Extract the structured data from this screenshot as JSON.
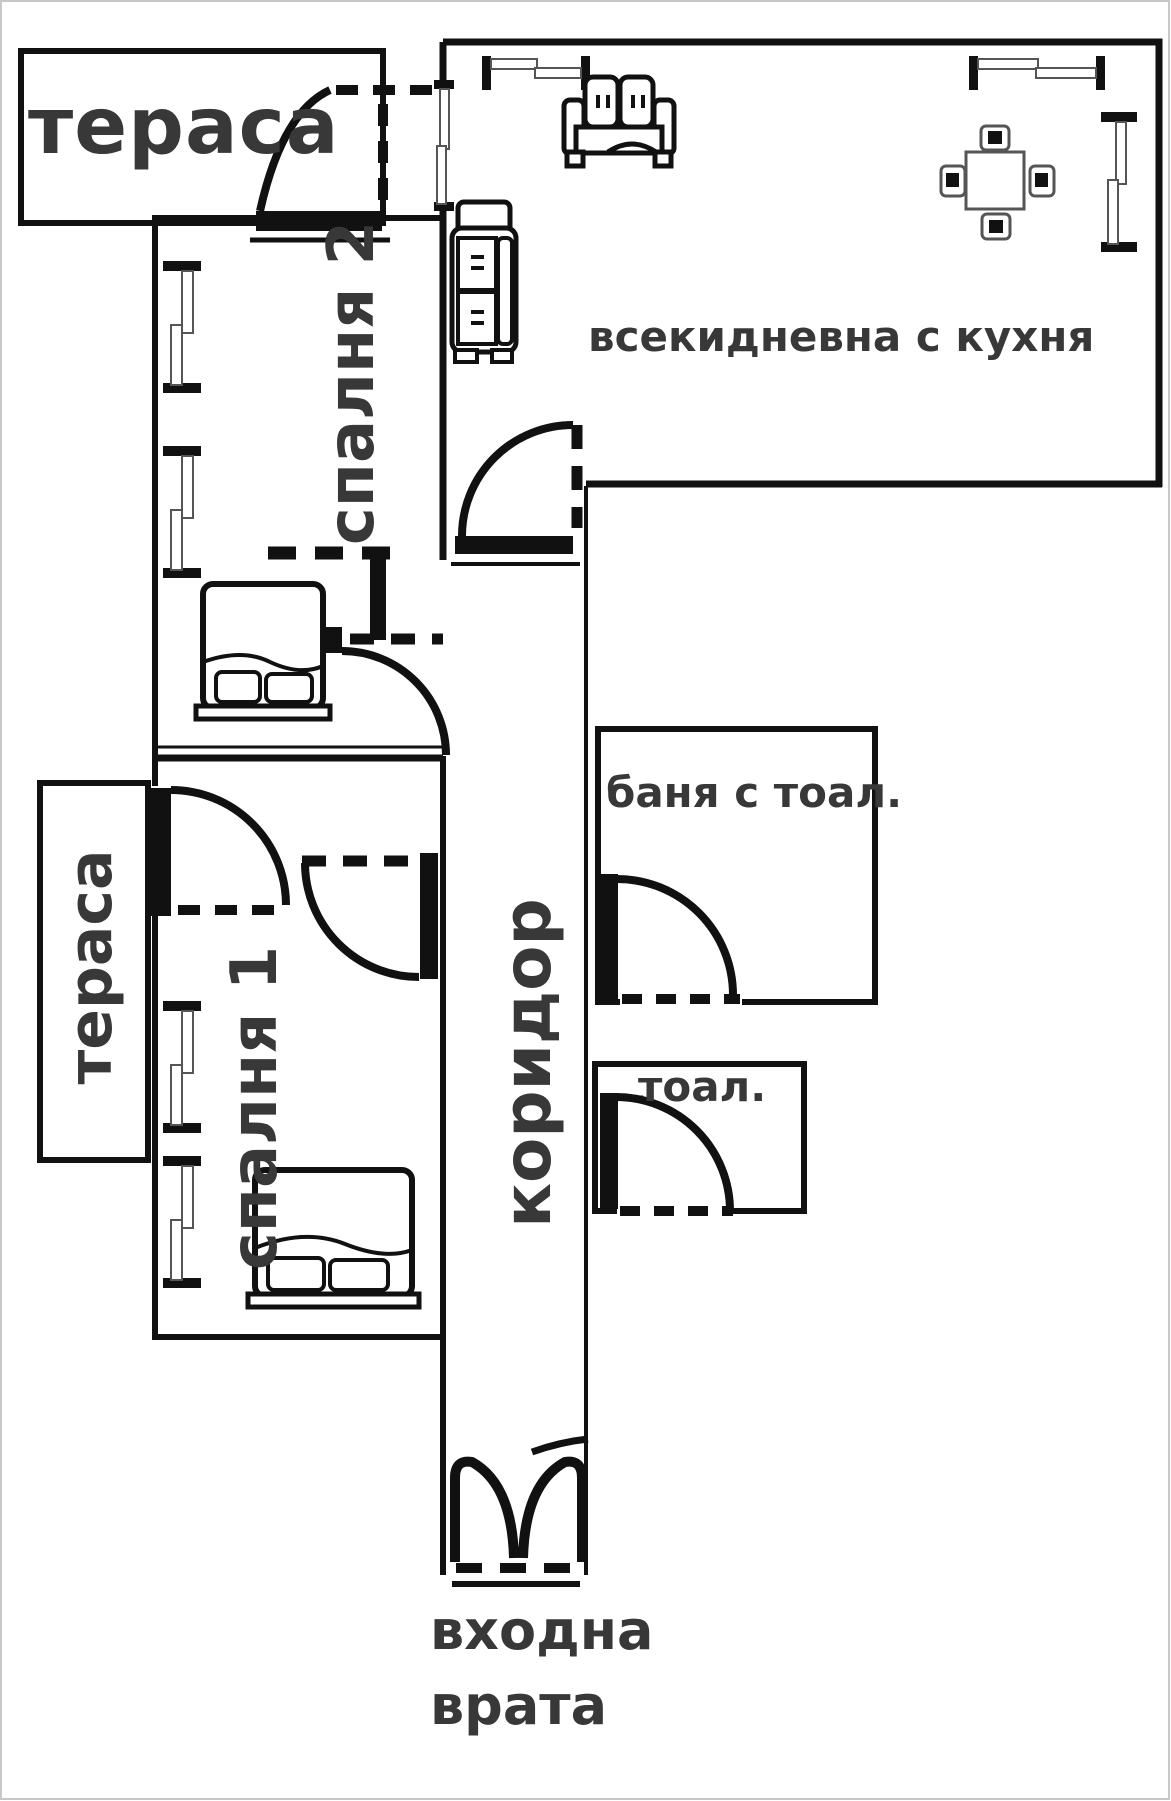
{
  "meta": {
    "type": "apartment-floor-plan",
    "language": "bulgarian"
  },
  "colors": {
    "wall": "#111111",
    "label_text": "#383838",
    "background": "#ffffff",
    "image_border": "#c8c8c8"
  },
  "rooms": [
    {
      "id": "terrace-top",
      "label": "тераса"
    },
    {
      "id": "bedroom-2",
      "label": "спалня 2"
    },
    {
      "id": "living-kitchen",
      "label": "всекидневна с кухня"
    },
    {
      "id": "bathroom",
      "label": "баня с тоал."
    },
    {
      "id": "corridor",
      "label": "коридор"
    },
    {
      "id": "toilet",
      "label": "тоал."
    },
    {
      "id": "terrace-left",
      "label": "тераса"
    },
    {
      "id": "bedroom-1",
      "label": "спалня 1"
    }
  ],
  "entrance": {
    "line1": "входна",
    "line2": "врата"
  },
  "icons": [
    "double-bed-icon x2",
    "sofa-icon",
    "armchair-icon",
    "dining-table-icon",
    "window-icon x8",
    "door-swing-icon x7",
    "entrance-double-door-icon"
  ]
}
